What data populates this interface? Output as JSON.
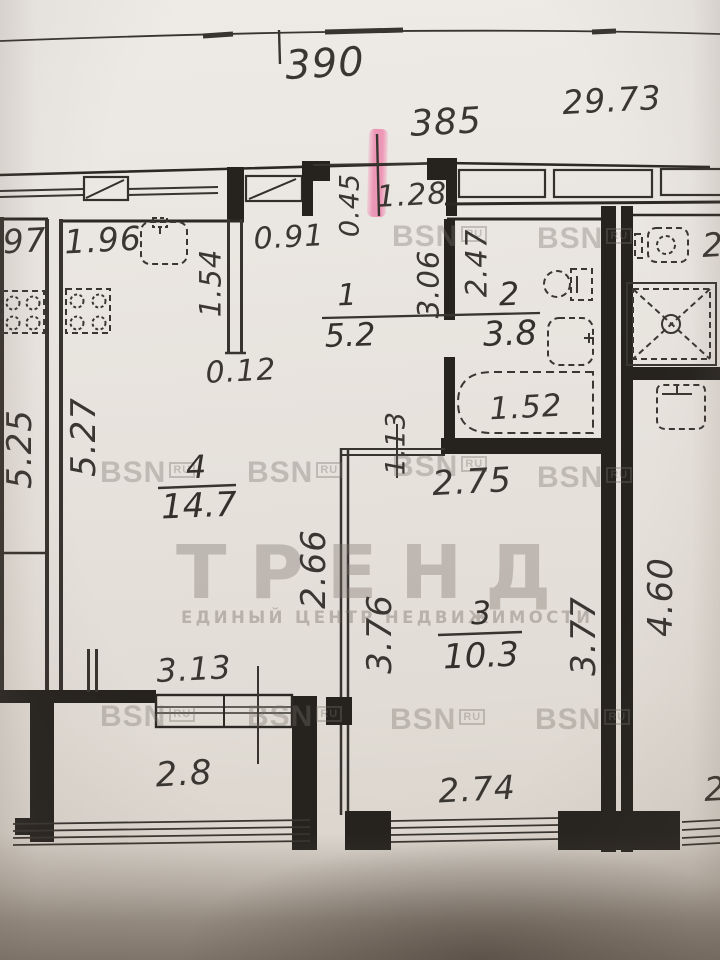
{
  "rooms": [
    {
      "number": "1",
      "area": "5.2"
    },
    {
      "number": "2",
      "area": "3.8"
    },
    {
      "number": "3",
      "area": "10.3"
    },
    {
      "number": "4",
      "area": "14.7"
    }
  ],
  "dims": [
    "390",
    "29.73",
    "385",
    "0.45",
    "1.28",
    ".97",
    "1.96",
    "0.91",
    "1.54",
    "3.06",
    "2.47",
    "0.12",
    "1.52",
    "2",
    "5.25",
    "5.27",
    "1.13",
    "2.75",
    "2.66",
    "3.76",
    "3.77",
    "4.60",
    "3.13",
    "2.8",
    "2.74",
    "2"
  ],
  "watermark": {
    "brand": "BSN",
    "brand_suffix": "RU",
    "agency": "ТРЕНД",
    "agency_subtitle": "ЕДИНЫЙ ЦЕНТР НЕДВИЖИМОСТИ"
  },
  "highlight": {
    "entrance_marker_color": "#ee649b"
  }
}
